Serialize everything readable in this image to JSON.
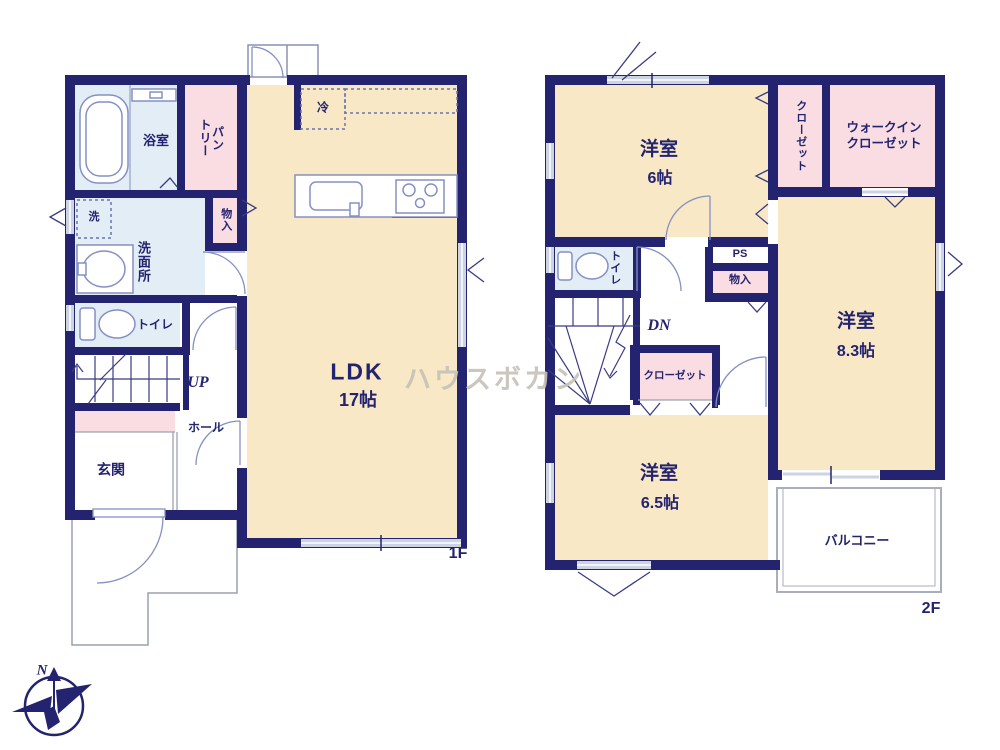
{
  "meta": {
    "title": "floor-plan",
    "floors": [
      "1F",
      "2F"
    ]
  },
  "colors": {
    "wall_navy": "#232370",
    "room_cream": "#f8e8c5",
    "wet_area_blue": "#e2edf6",
    "closet_pink": "#fadde2",
    "fixture_stroke": "#8590c4",
    "window_gray": "#ccd3e2",
    "porch_gray": "#9aa2b0",
    "watermark_gray": "#c7c2b8"
  },
  "watermark": {
    "text": "ハウスボカン"
  },
  "compass": {
    "north_label": "N"
  },
  "floor1": {
    "floor_tag": "1F",
    "labels": {
      "bath": "浴室",
      "pantry": "パン\nトリー",
      "laundry": "洗",
      "washroom": "洗面所",
      "storage": "物入",
      "toilet": "トイレ",
      "stairs_up": "UP",
      "hall": "ホール",
      "entrance": "玄関",
      "ldk": "LDK",
      "ldk_size": "17帖",
      "fridge": "冷"
    }
  },
  "floor2": {
    "floor_tag": "2F",
    "labels": {
      "room6": "洋室",
      "room6_size": "6帖",
      "closet_vertical": "クローゼット",
      "walkin_closet": "ウォークイン\nクローゼット",
      "room83": "洋室",
      "room83_size": "8.3帖",
      "toilet": "トイレ",
      "stairs_down": "DN",
      "ps": "PS",
      "storage": "物入",
      "closet": "クローゼット",
      "room65": "洋室",
      "room65_size": "6.5帖",
      "balcony": "バルコニー"
    }
  }
}
